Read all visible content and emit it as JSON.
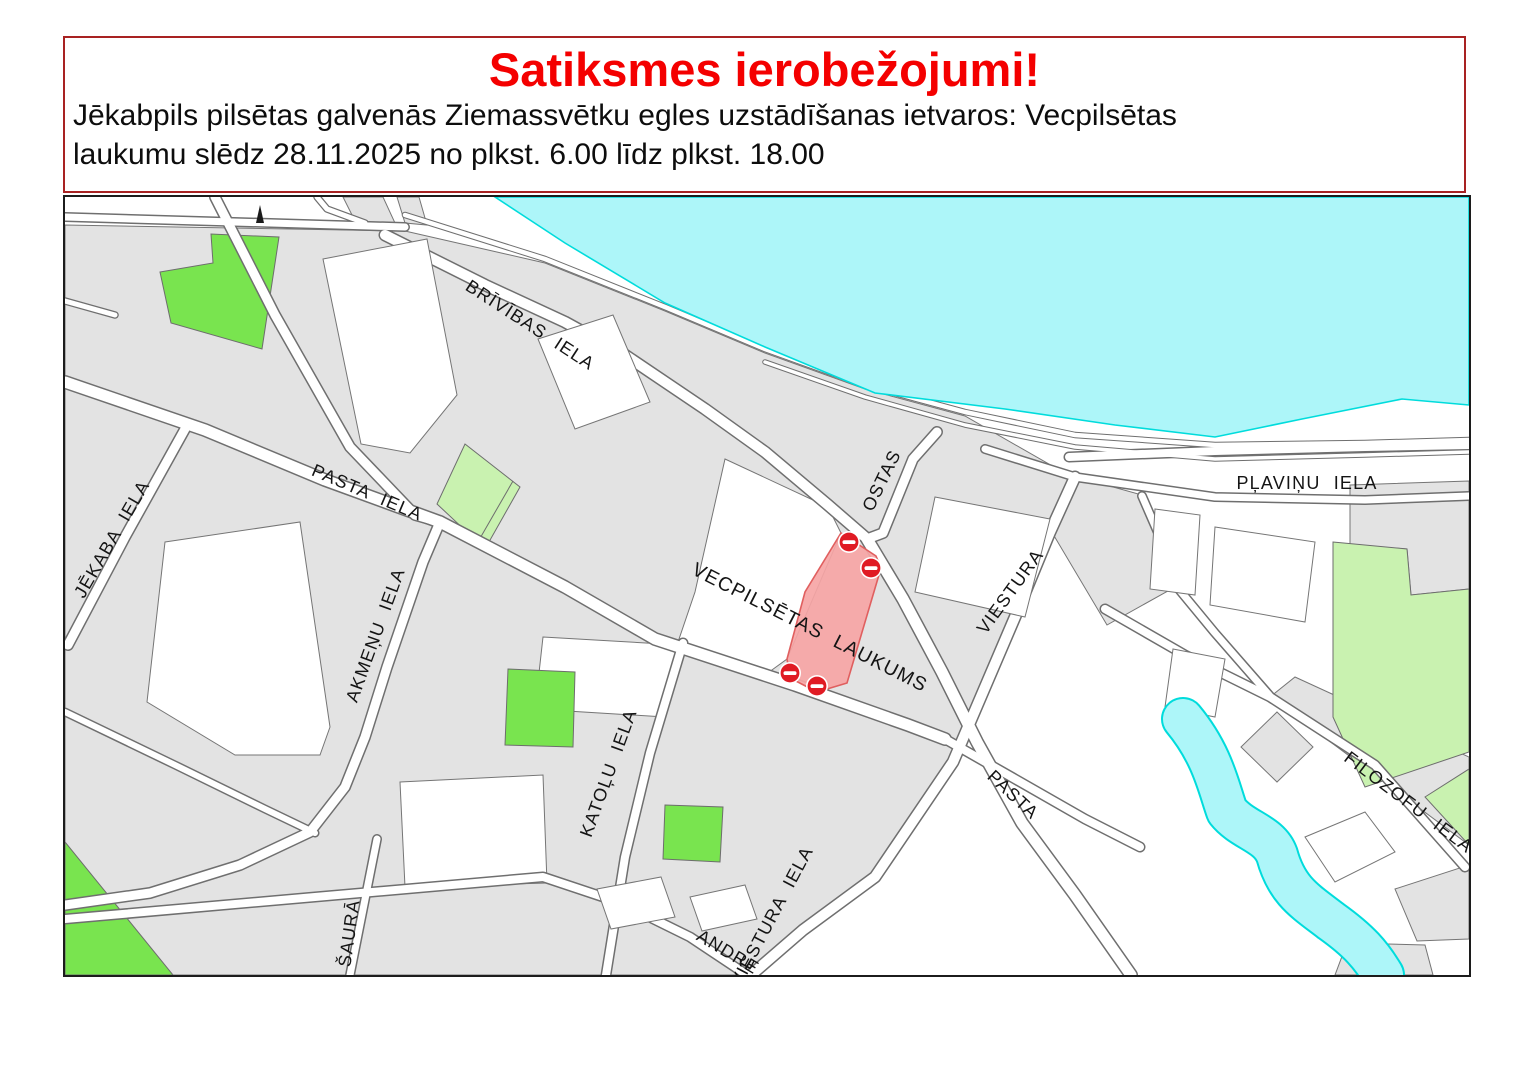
{
  "header": {
    "title": "Satiksmes ierobežojumi!",
    "lines": [
      "Jēkabpils pilsētas galvenās Ziemassvētku egles uzstādīšanas ietvaros: Vecpilsētas",
      "laukumu slēdz 28.11.2025 no plkst. 6.00 līdz plkst. 18.00"
    ]
  },
  "map": {
    "labels": [
      {
        "id": "brivibas-iela",
        "text": "BRĪVĪBAS IELA"
      },
      {
        "id": "plavinu-iela",
        "text": "PĻAVIŅU IELA"
      },
      {
        "id": "ostas",
        "text": "OSTAS"
      },
      {
        "id": "viestura-upper",
        "text": "VIESTURA"
      },
      {
        "id": "pasta-iela",
        "text": "PASTA IELA"
      },
      {
        "id": "jekaba-iela",
        "text": "JĒKABA IELA"
      },
      {
        "id": "akmenu-iela",
        "text": "AKMEŅU IELA"
      },
      {
        "id": "vecpilsetas-laukums",
        "text": "VECPILSĒTAS LAUKUMS"
      },
      {
        "id": "katolu-iela",
        "text": "KATOĻU IELA"
      },
      {
        "id": "viestura-iela",
        "text": "VIESTURA IELA"
      },
      {
        "id": "pasta-lower",
        "text": "PASTA"
      },
      {
        "id": "saura",
        "text": "ŠAURĀ"
      },
      {
        "id": "andreja",
        "text": "ANDRE"
      },
      {
        "id": "filozofu-iela",
        "text": "FILOZOFU IELA"
      }
    ],
    "restricted_area": {
      "label": "VECPILSĒTAS LAUKUMS",
      "no_entry_sign_count": 4
    },
    "colors": {
      "title_red": "#f40000",
      "notice_border": "#a82222",
      "water": "#adf6f9",
      "water_edge": "#00dcdc",
      "park_green": "#79e44f",
      "park_pale_green": "#c9f2b0",
      "block_gray": "#e3e3e3",
      "restricted_fill": "#f6a5a5",
      "no_entry_red": "#e01b24"
    }
  }
}
